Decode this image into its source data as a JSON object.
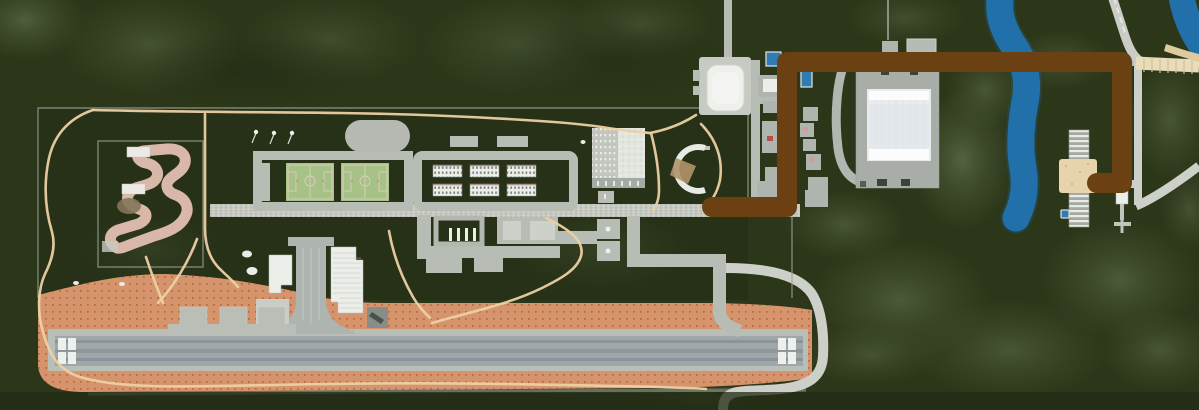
{
  "map": {
    "view": "aerial-satellite",
    "description": "Aerial satellite map of a forested campus: go-kart track, twin soccer fields, barracks blocks, parking structure, baseball field, airfield with runway and terminal, swimming pools, a stadium, a river with riverside pier station, and a hand-drawn brown route from the campus main road to the riverside station",
    "palette": {
      "forest-base": "#2c3719",
      "forest-light": "#7e8e68",
      "forest-dark": "#1c2410",
      "campus-green": "#273117",
      "road-gray": "#b7bcb4",
      "road-light": "#ccd0c8",
      "cobble-gray": "#c6c9c1",
      "fence-gray": "#98a094",
      "path-tan": "#ecd0a4",
      "kart-track": "#d9b7a9",
      "sports-field": "#a7c286",
      "field-line": "#e3cfc6",
      "building-white": "#eceee9",
      "window-dark": "#646a64",
      "oval-gray": "#b5b9b2",
      "apron-salmon": "#d6946d",
      "apron-dot": "#b2613e",
      "runway-base": "#b9beb6",
      "runway-gray": "#a0a7aa",
      "runway-dark": "#8c9499",
      "threshold-white": "#eef0ed",
      "stadium-gray": "#a9ada8",
      "stadium-roof": "#e9ecee",
      "river-blue": "#2170aa",
      "pool-blue": "#2d7cb5",
      "sand-beige": "#e7d4ac",
      "beach-tan": "#dfc99f",
      "bridge-white": "#eceae6",
      "route-brown": "#6b4113",
      "infield-tan": "#b3936a",
      "helipad-gray": "#878d87"
    },
    "route": {
      "name": "drawn-route-annotation",
      "color_key": "route-brown",
      "stroke_width": 20,
      "points": [
        [
          712,
          207
        ],
        [
          787,
          207
        ],
        [
          787,
          62
        ],
        [
          1122,
          62
        ],
        [
          1122,
          183
        ],
        [
          1097,
          183
        ]
      ]
    },
    "features": [
      "forest",
      "campus-area",
      "go-kart-track",
      "soccer-fields",
      "barracks-blocks",
      "running-oval",
      "parking-structure",
      "baseball-field",
      "pavilion",
      "main-cobble-road",
      "walking-paths",
      "airfield-apron",
      "runway",
      "terminal-buildings",
      "taxiway",
      "helipad",
      "ice-rink",
      "swimming-pools",
      "stadium",
      "river",
      "beach",
      "pier-station",
      "boat-dock",
      "perimeter-road"
    ]
  }
}
